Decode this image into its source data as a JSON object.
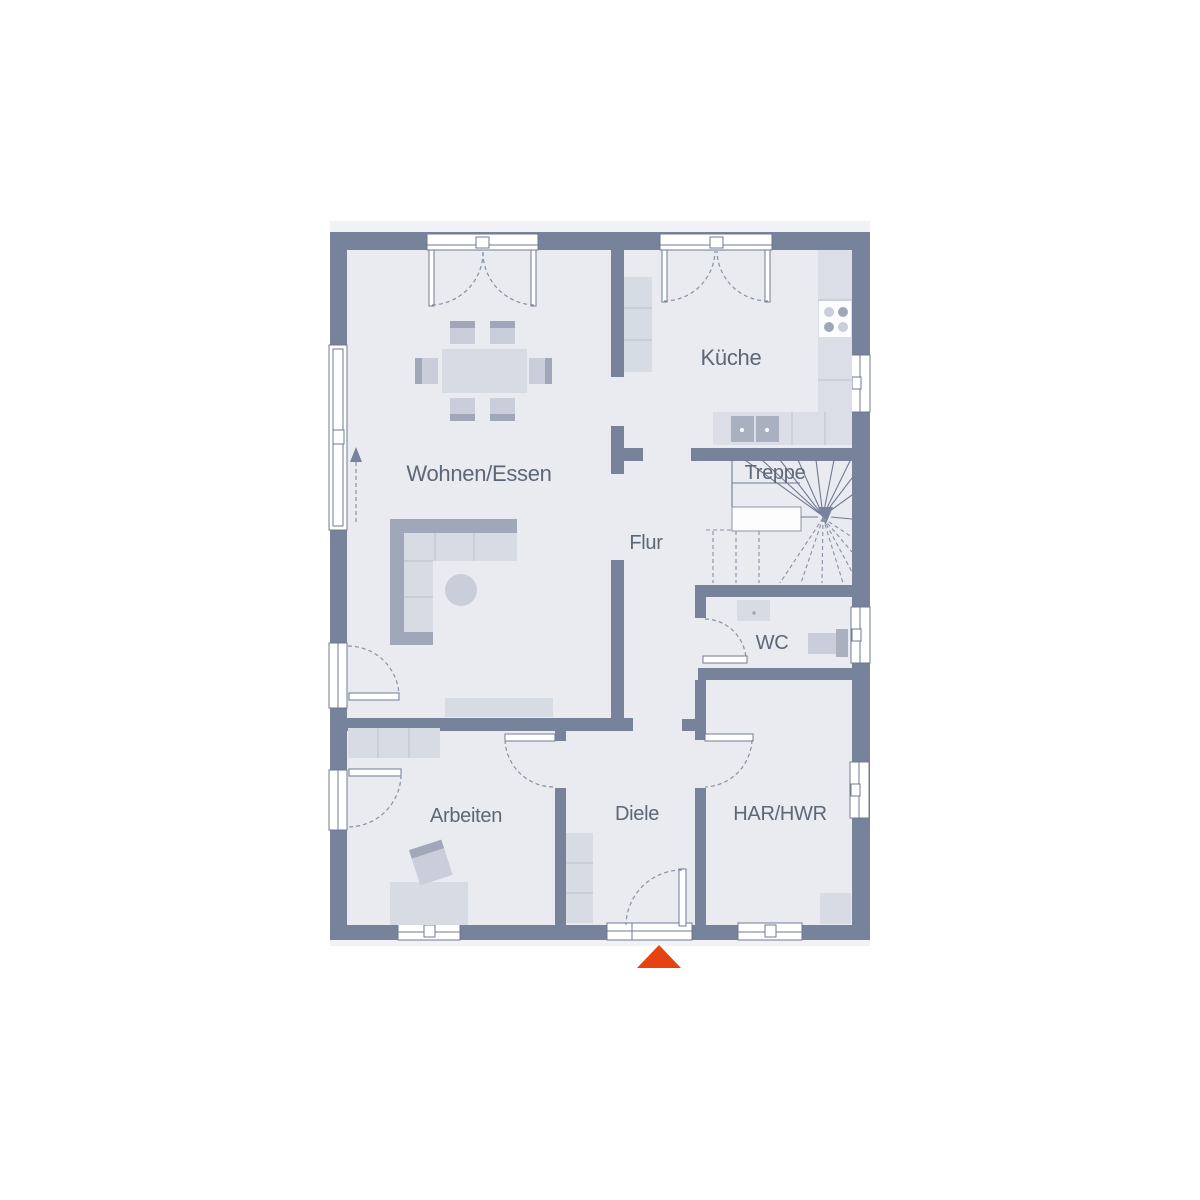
{
  "colors": {
    "wall": "#77829B",
    "floor": "#E9EBF1",
    "outline": "#F0F2F5",
    "furniture": "#D7DBE4",
    "furniture_mid": "#C9CEDA",
    "furniture_dark": "#9FA7B9",
    "counter": "#DBDEE6",
    "sink": "#A9B1C1",
    "line": "#6F7B92",
    "dashed": "#8691A5",
    "divline": "#BCC2CF",
    "text": "#5D6777",
    "entrance_arrow": "#E5430F"
  },
  "floor_plan": {
    "rooms": [
      {
        "id": "wohnen-essen",
        "label": "Wohnen/Essen"
      },
      {
        "id": "kueche",
        "label": "Küche"
      },
      {
        "id": "treppe",
        "label": "Treppe"
      },
      {
        "id": "flur",
        "label": "Flur"
      },
      {
        "id": "wc",
        "label": "WC"
      },
      {
        "id": "arbeiten",
        "label": "Arbeiten"
      },
      {
        "id": "diele",
        "label": "Diele"
      },
      {
        "id": "har-hwr",
        "label": "HAR/HWR"
      }
    ],
    "entrance": {
      "marker": "triangle-up",
      "color": "#E5430F"
    }
  }
}
